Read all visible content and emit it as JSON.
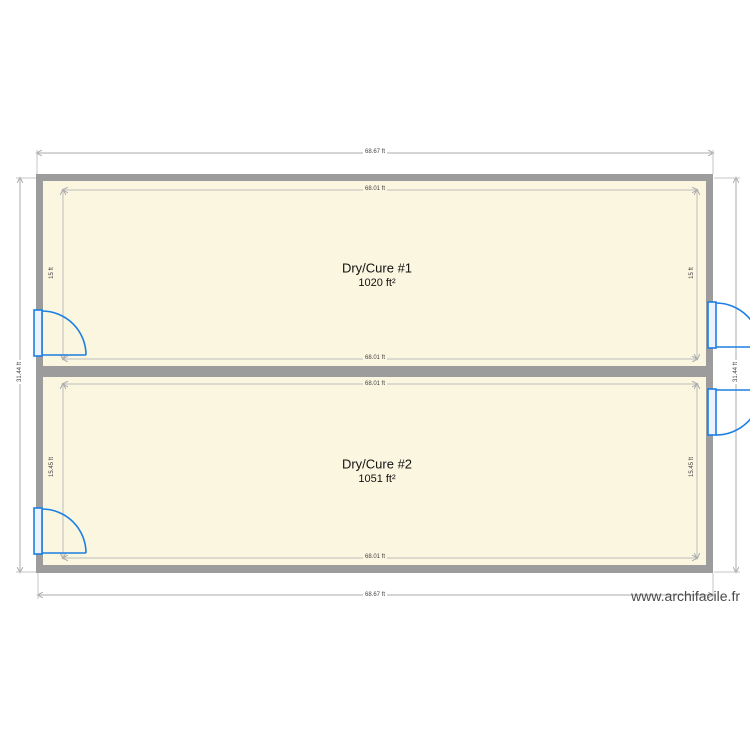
{
  "app": {
    "watermark": "www.archifacile.fr"
  },
  "plan": {
    "rooms": [
      {
        "name": "Dry/Cure #1",
        "area": "1020 ft²",
        "width_label": "68.01 ft",
        "height_label": "15 ft"
      },
      {
        "name": "Dry/Cure #2",
        "area": "1051 ft²",
        "width_label": "68.01 ft",
        "height_label": "15.45 ft"
      }
    ],
    "dimensions": {
      "outer_width": "68.67 ft",
      "outer_height": "31.44 ft"
    },
    "icons": {
      "door": "quarter-circle-door-swing",
      "dimension_arrow": "thin-line-arrowhead"
    },
    "colors": {
      "wall": "#9c9c9c",
      "room_fill": "#faf6e0",
      "door": "#1d7fe3",
      "dimension_line": "#ababab",
      "dimension_text": "#444444",
      "room_text": "#111111",
      "watermark_text": "#4a4a4a"
    }
  }
}
